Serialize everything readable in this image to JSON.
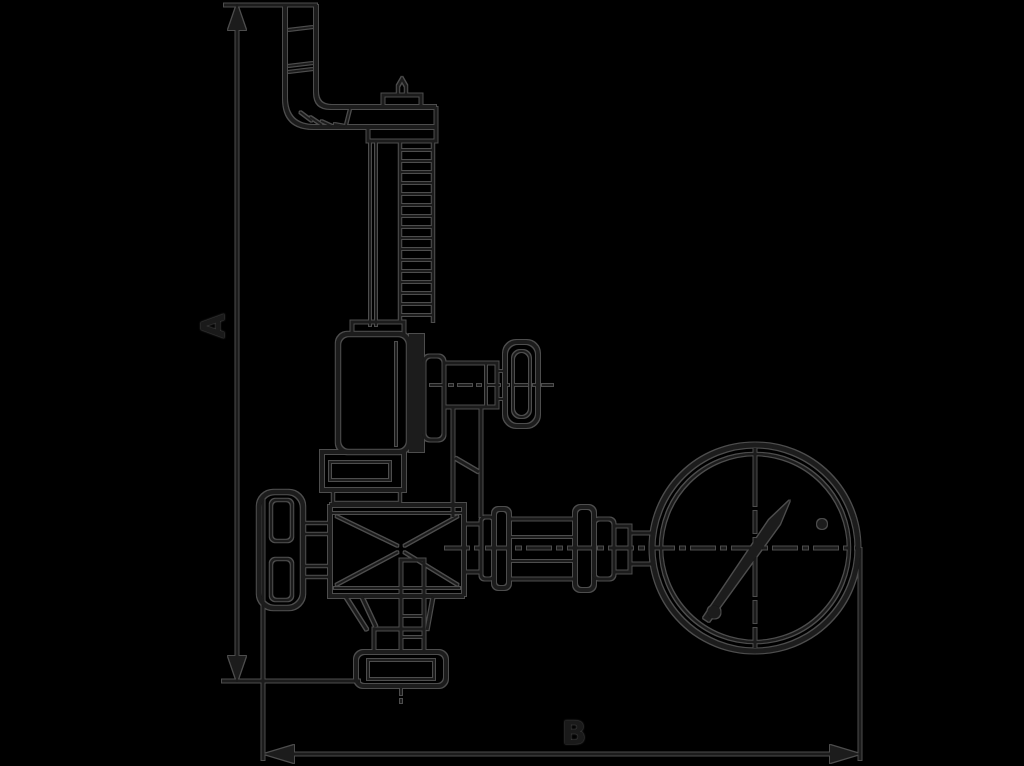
{
  "canvas": {
    "width": 1024,
    "height": 766,
    "background_color": "#000000"
  },
  "drawing": {
    "kind": "technical-line-drawing",
    "stroke_color": "#1a1a1a",
    "halo_color": "#4d4d4d",
    "dimensions": {
      "height": {
        "label": "A"
      },
      "width": {
        "label": "B"
      }
    },
    "parts": [
      "mounting-bracket",
      "adjusting-screw-spring",
      "spring-housing",
      "test-valve-knob",
      "bonnet-flange",
      "handwheel",
      "valve-body",
      "outlet-flange",
      "pipe-couplings",
      "pressure-gauge",
      "gauge-needle",
      "dimension-line-a",
      "dimension-line-b"
    ]
  }
}
